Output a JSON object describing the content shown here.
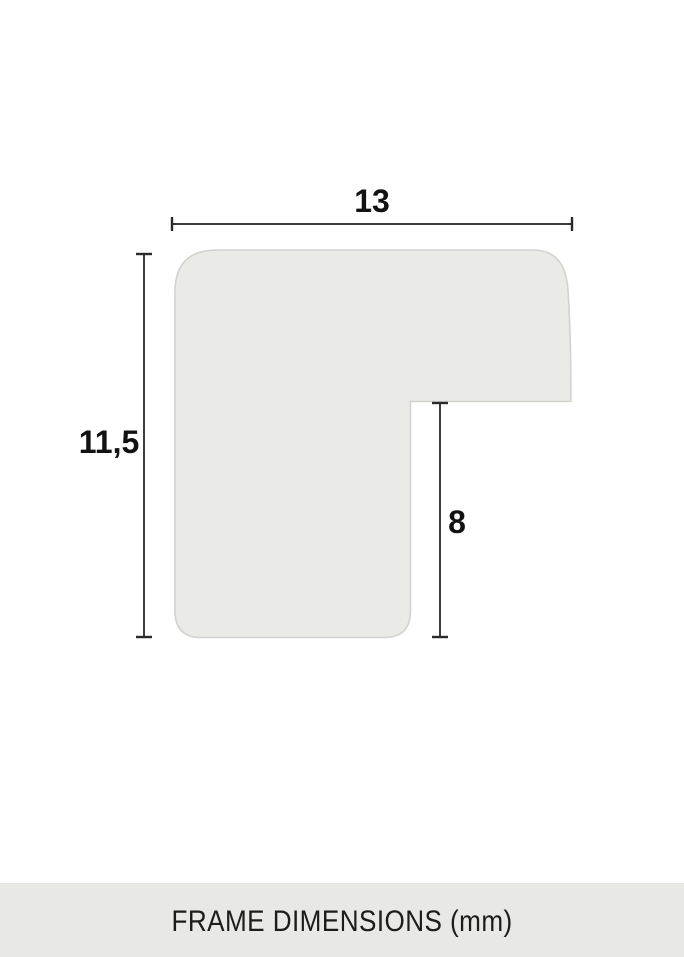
{
  "diagram": {
    "kind": "frame-profile-cross-section",
    "unit": "mm",
    "dimensions": {
      "width": {
        "value": "13",
        "unit": "mm"
      },
      "height": {
        "value": "11,5",
        "unit": "mm"
      },
      "rabbet_height": {
        "value": "8",
        "unit": "mm"
      }
    }
  },
  "footer": {
    "title": "FRAME DIMENSIONS (mm)"
  },
  "colors": {
    "background": "#ffffff",
    "profile_fill": "#eaeae7",
    "profile_stroke": "#d2d2cf",
    "dim_line": "#3d3d3d",
    "dim_tick": "#2a2a2a",
    "label_text": "#121212",
    "footer_bg": "#e8e8e4",
    "footer_text": "#1c1c1c"
  }
}
